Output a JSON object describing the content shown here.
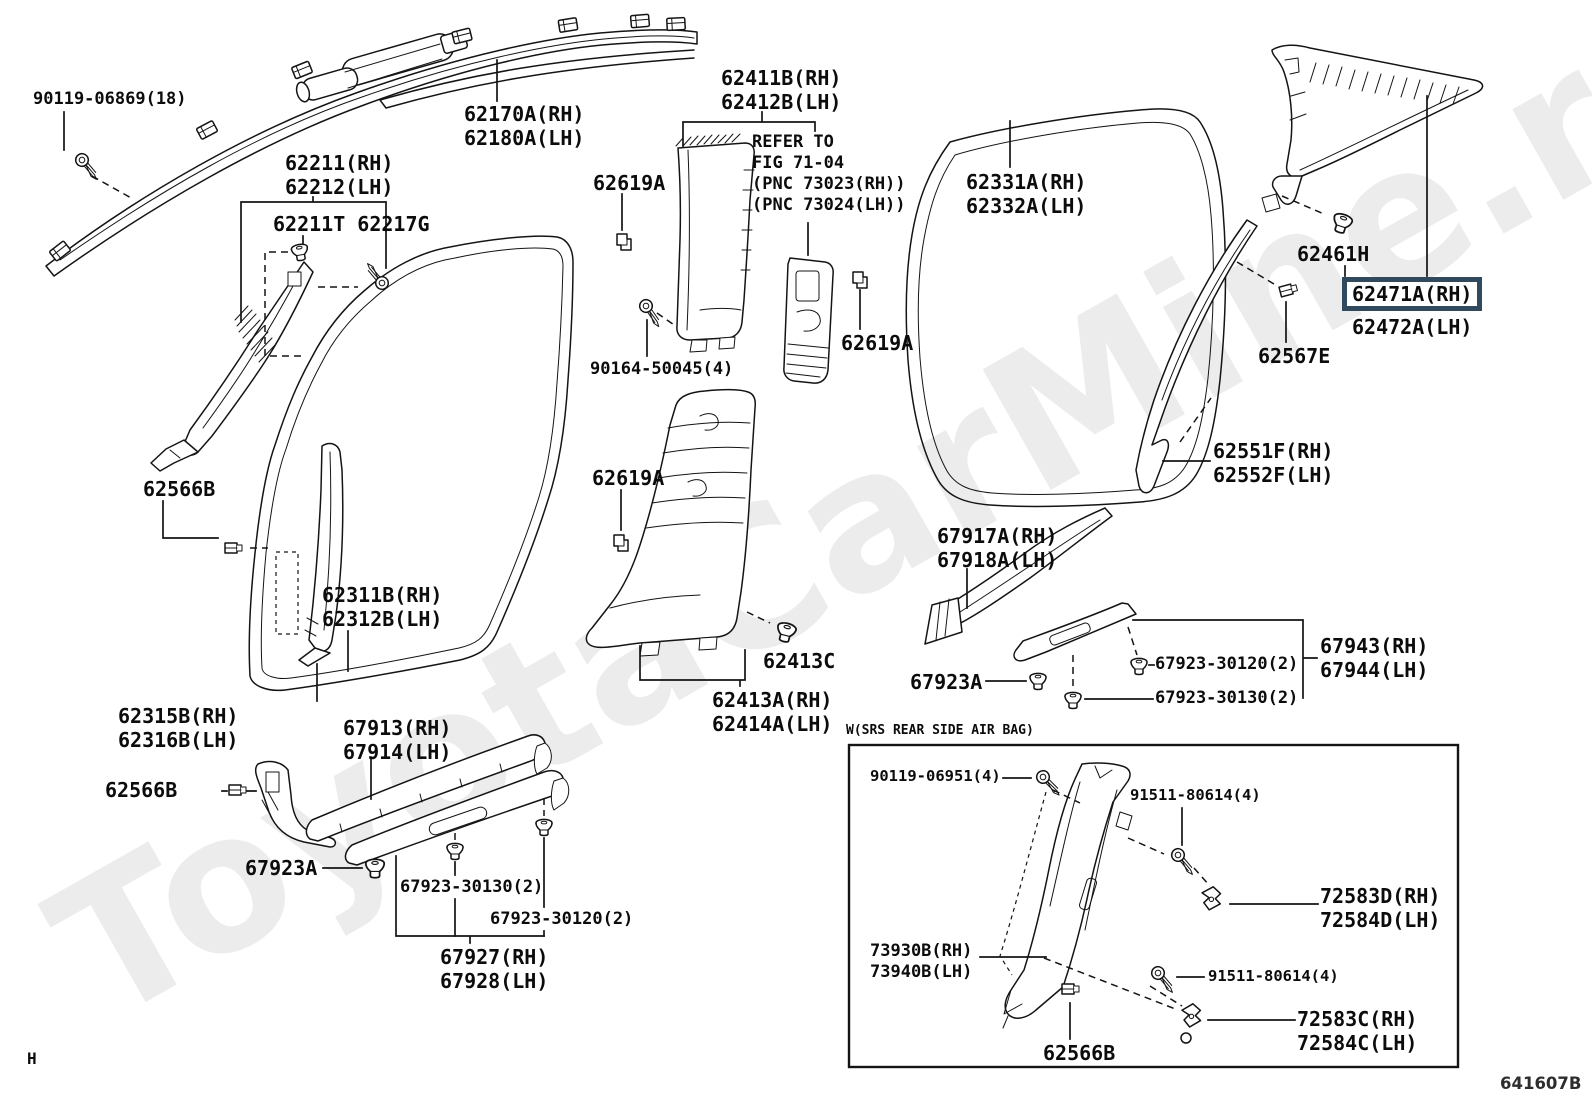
{
  "diagram": {
    "doc_code": "641607B",
    "corner_mark": "H",
    "watermark": "ToyotaCarMine.ru",
    "highlight_color": "#31495c",
    "srs_box_title": "W(SRS REAR SIDE AIR BAG)",
    "labels": [
      {
        "id": "90119-06869",
        "lines": [
          "90119-06869(18)"
        ],
        "x": 33,
        "y": 89,
        "size": 17,
        "link": true
      },
      {
        "id": "62170A",
        "lines": [
          "62170A(RH)",
          "62180A(LH)"
        ],
        "x": 464,
        "y": 102,
        "size": 20,
        "link": true
      },
      {
        "id": "62211",
        "lines": [
          "62211(RH)",
          "62212(LH)"
        ],
        "x": 285,
        "y": 151,
        "size": 20,
        "link": true
      },
      {
        "id": "62211T-62217G",
        "lines": [
          "62211T 62217G"
        ],
        "x": 273,
        "y": 212,
        "size": 20,
        "link": true
      },
      {
        "id": "62411B",
        "lines": [
          "62411B(RH)",
          "62412B(LH)"
        ],
        "x": 721,
        "y": 66,
        "size": 20,
        "link": true
      },
      {
        "id": "refer-note",
        "lines": [
          "REFER TO",
          "FIG 71-04",
          "(PNC 73023(RH))",
          "(PNC 73024(LH))"
        ],
        "x": 752,
        "y": 132,
        "size": 17,
        "link": false
      },
      {
        "id": "62619A-top",
        "lines": [
          "62619A"
        ],
        "x": 593,
        "y": 171,
        "size": 20,
        "link": true
      },
      {
        "id": "62331A",
        "lines": [
          "62331A(RH)",
          "62332A(LH)"
        ],
        "x": 966,
        "y": 170,
        "size": 20,
        "link": true
      },
      {
        "id": "90164-50045",
        "lines": [
          "90164-50045(4)"
        ],
        "x": 590,
        "y": 359,
        "size": 17,
        "link": true
      },
      {
        "id": "62619A-mid",
        "lines": [
          "62619A"
        ],
        "x": 841,
        "y": 331,
        "size": 20,
        "link": true
      },
      {
        "id": "62461H",
        "lines": [
          "62461H"
        ],
        "x": 1297,
        "y": 242,
        "size": 20,
        "link": true
      },
      {
        "id": "62471A",
        "lines": [
          "62471A(RH)"
        ],
        "x": 1342,
        "y": 277,
        "size": 20,
        "link": true,
        "box": true
      },
      {
        "id": "62472A",
        "lines": [
          "62472A(LH)"
        ],
        "x": 1352,
        "y": 315,
        "size": 20,
        "link": true
      },
      {
        "id": "62567E",
        "lines": [
          "62567E"
        ],
        "x": 1258,
        "y": 344,
        "size": 20,
        "link": true
      },
      {
        "id": "62551F",
        "lines": [
          "62551F(RH)",
          "62552F(LH)"
        ],
        "x": 1213,
        "y": 439,
        "size": 20,
        "link": true
      },
      {
        "id": "62566B-up",
        "lines": [
          "62566B"
        ],
        "x": 143,
        "y": 477,
        "size": 20,
        "link": true
      },
      {
        "id": "62619A-low",
        "lines": [
          "62619A"
        ],
        "x": 592,
        "y": 466,
        "size": 20,
        "link": true
      },
      {
        "id": "62311B",
        "lines": [
          "62311B(RH)",
          "62312B(LH)"
        ],
        "x": 322,
        "y": 583,
        "size": 20,
        "link": true
      },
      {
        "id": "67917A",
        "lines": [
          "67917A(RH)",
          "67918A(LH)"
        ],
        "x": 937,
        "y": 524,
        "size": 20,
        "link": true
      },
      {
        "id": "62413C",
        "lines": [
          "62413C"
        ],
        "x": 763,
        "y": 649,
        "size": 20,
        "link": true
      },
      {
        "id": "62413A",
        "lines": [
          "62413A(RH)",
          "62414A(LH)"
        ],
        "x": 712,
        "y": 688,
        "size": 20,
        "link": true
      },
      {
        "id": "67923A-right",
        "lines": [
          "67923A"
        ],
        "x": 910,
        "y": 670,
        "size": 20,
        "link": true
      },
      {
        "id": "67923-30120-right",
        "lines": [
          "67923-30120(2)"
        ],
        "x": 1155,
        "y": 654,
        "size": 17,
        "link": true
      },
      {
        "id": "67923-30130-right",
        "lines": [
          "67923-30130(2)"
        ],
        "x": 1155,
        "y": 688,
        "size": 17,
        "link": true
      },
      {
        "id": "67943",
        "lines": [
          "67943(RH)",
          "67944(LH)"
        ],
        "x": 1320,
        "y": 634,
        "size": 20,
        "link": true
      },
      {
        "id": "62315B",
        "lines": [
          "62315B(RH)",
          "62316B(LH)"
        ],
        "x": 118,
        "y": 704,
        "size": 20,
        "link": true
      },
      {
        "id": "67913",
        "lines": [
          "67913(RH)",
          "67914(LH)"
        ],
        "x": 343,
        "y": 716,
        "size": 20,
        "link": true
      },
      {
        "id": "62566B-low",
        "lines": [
          "62566B"
        ],
        "x": 105,
        "y": 778,
        "size": 20,
        "link": true
      },
      {
        "id": "67923A-left",
        "lines": [
          "67923A"
        ],
        "x": 245,
        "y": 856,
        "size": 20,
        "link": true
      },
      {
        "id": "67923-30130-left",
        "lines": [
          "67923-30130(2)"
        ],
        "x": 400,
        "y": 877,
        "size": 17,
        "link": true
      },
      {
        "id": "67923-30120-left",
        "lines": [
          "67923-30120(2)"
        ],
        "x": 490,
        "y": 909,
        "size": 17,
        "link": true
      },
      {
        "id": "67927",
        "lines": [
          "67927(RH)",
          "67928(LH)"
        ],
        "x": 440,
        "y": 945,
        "size": 20,
        "link": true
      },
      {
        "id": "srs-title",
        "lines": [
          "W(SRS REAR SIDE AIR BAG)"
        ],
        "x": 846,
        "y": 722,
        "size": 13,
        "link": false
      },
      {
        "id": "90119-06951",
        "lines": [
          "90119-06951(4)"
        ],
        "x": 870,
        "y": 767,
        "size": 15.5,
        "link": true
      },
      {
        "id": "91511-80614-up",
        "lines": [
          "91511-80614(4)"
        ],
        "x": 1130,
        "y": 786,
        "size": 15.5,
        "link": true
      },
      {
        "id": "72583D",
        "lines": [
          "72583D(RH)",
          "72584D(LH)"
        ],
        "x": 1320,
        "y": 884,
        "size": 20,
        "link": true
      },
      {
        "id": "73930B",
        "lines": [
          "73930B(RH)",
          "73940B(LH)"
        ],
        "x": 870,
        "y": 941,
        "size": 17,
        "link": true
      },
      {
        "id": "91511-80614-low",
        "lines": [
          "91511-80614(4)"
        ],
        "x": 1208,
        "y": 967,
        "size": 15.5,
        "link": true
      },
      {
        "id": "72583C",
        "lines": [
          "72583C(RH)",
          "72584C(LH)"
        ],
        "x": 1297,
        "y": 1007,
        "size": 20,
        "link": true
      },
      {
        "id": "62566B-box",
        "lines": [
          "62566B"
        ],
        "x": 1043,
        "y": 1041,
        "size": 20,
        "link": true
      },
      {
        "id": "doc-code",
        "lines": [
          "641607B"
        ],
        "x": 1500,
        "y": 1073,
        "size": 16.5,
        "link": false,
        "sans": true
      },
      {
        "id": "corner-mark",
        "lines": [
          "H"
        ],
        "x": 27,
        "y": 1048,
        "size": 16,
        "link": false
      }
    ]
  }
}
